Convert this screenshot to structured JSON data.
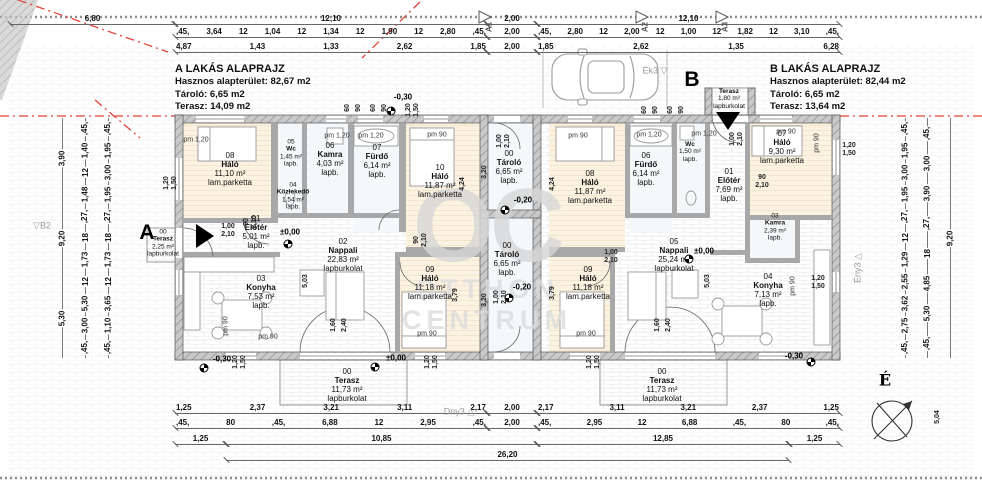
{
  "title_blocks": {
    "left": {
      "title": "A LAKÁS ALAPRAJZ",
      "l1": "Hasznos alapterület: 82,67 m2",
      "l2": "Tároló: 6,65 m2",
      "l3": "Terasz:  14,09 m2"
    },
    "right": {
      "title": "B LAKÁS ALAPRAJZ",
      "l1": "Hasznos alapterület: 82,44 m2",
      "l2": "Tároló: 6,65 m2",
      "l3": "Terasz:  13,64 m2"
    }
  },
  "watermark": {
    "big": "OC",
    "l1": "OTTHON",
    "l2": "CENTRUM"
  },
  "rooms": [
    {
      "n": "08",
      "nm": "Háló",
      "a": "11,10 m²",
      "f": "lam.parketta",
      "x": 230,
      "y": 170
    },
    {
      "n": "05",
      "nm": "Wc",
      "a": "1,45 m²",
      "f": "lapb.",
      "x": 291,
      "y": 153,
      "s": 1
    },
    {
      "n": "06",
      "nm": "Kamra",
      "a": "4,03 m²",
      "f": "lapb.",
      "x": 330,
      "y": 160
    },
    {
      "n": "07",
      "nm": "Fürdő",
      "a": "6,14 m²",
      "f": "lapb.",
      "x": 377,
      "y": 162
    },
    {
      "n": "10",
      "nm": "Háló",
      "a": "11,87 m²",
      "f": "lam.parketta",
      "x": 440,
      "y": 182
    },
    {
      "n": "04",
      "nm": "Közlekedő",
      "a": "1,54 m²",
      "f": "lapb.",
      "x": 293,
      "y": 196,
      "s": 1
    },
    {
      "n": "01",
      "nm": "Előtér",
      "a": "5,01 m²",
      "f": "lapb.",
      "x": 256,
      "y": 233
    },
    {
      "n": "00",
      "nm": "Terasz",
      "a": "2,25 m²",
      "f": "lapburkolat",
      "x": 163,
      "y": 243,
      "s": 1
    },
    {
      "n": "02",
      "nm": "Nappali",
      "a": "22,83 m²",
      "f": "lapburkolat",
      "x": 343,
      "y": 256
    },
    {
      "n": "03",
      "nm": "Konyha",
      "a": "7,53 m²",
      "f": "lapb.",
      "x": 261,
      "y": 293
    },
    {
      "n": "09",
      "nm": "Háló",
      "a": "11,18 m²",
      "f": "lam.parketta",
      "x": 430,
      "y": 284
    },
    {
      "n": "00",
      "nm": "Tároló",
      "a": "6,65 m²",
      "f": "lapb.",
      "x": 509,
      "y": 168
    },
    {
      "n": "00",
      "nm": "Tároló",
      "a": "6,65 m²",
      "f": "lapb.",
      "x": 507,
      "y": 260
    },
    {
      "n": "00",
      "nm": "Terasz",
      "a": "11,73 m²",
      "f": "lapburkolat",
      "x": 347,
      "y": 386
    },
    {
      "n": "08",
      "nm": "Háló",
      "a": "11,87 m²",
      "f": "lam.parketta",
      "x": 590,
      "y": 188
    },
    {
      "n": "06",
      "nm": "Fürdő",
      "a": "6,14 m²",
      "f": "lapb.",
      "x": 646,
      "y": 170
    },
    {
      "n": "",
      "nm": "Wc",
      "a": "1,50 m²",
      "f": "lapb.",
      "x": 690,
      "y": 152,
      "s": 1
    },
    {
      "n": "01",
      "nm": "Előtér",
      "a": "7,69 m²",
      "f": "lapb.",
      "x": 729,
      "y": 186
    },
    {
      "n": "07",
      "nm": "Háló",
      "a": "9,30 m²",
      "f": "lam.parketta",
      "x": 782,
      "y": 148
    },
    {
      "n": "03",
      "nm": "Kamra",
      "a": "2,39 m²",
      "f": "lapb.",
      "x": 775,
      "y": 227,
      "s": 1
    },
    {
      "n": "04",
      "nm": "Konyha",
      "a": "7,13 m²",
      "f": "lapb.",
      "x": 768,
      "y": 291
    },
    {
      "n": "05",
      "nm": "Nappali",
      "a": "25,24 m²",
      "f": "lapburkolat",
      "x": 674,
      "y": 256
    },
    {
      "n": "09",
      "nm": "Háló",
      "a": "11,18 m²",
      "f": "lam.parketta",
      "x": 588,
      "y": 284
    },
    {
      "n": "",
      "nm": "Terasz",
      "a": "1,80 m²",
      "f": "lapburkolat",
      "x": 729,
      "y": 99,
      "s": 1
    },
    {
      "n": "00",
      "nm": "Terasz",
      "a": "11,73 m²",
      "f": "lapburkolat",
      "x": 662,
      "y": 386
    }
  ],
  "dim_rows": [
    {
      "y": 24,
      "segs": [
        {
          "x1": 10,
          "x2": 175,
          "v": [
            "6,80"
          ]
        },
        {
          "x1": 175,
          "x2": 487,
          "v": [
            "12,10"
          ]
        },
        {
          "x1": 487,
          "x2": 537,
          "v": [
            "2,00"
          ]
        },
        {
          "x1": 537,
          "x2": 840,
          "v": [
            "12,10"
          ]
        }
      ]
    },
    {
      "y": 37,
      "segs": [
        {
          "x1": 175,
          "x2": 487,
          "v": [
            ",45,",
            "3,64",
            "12",
            "1,04",
            "12",
            "1,34",
            "12",
            "1,90",
            "12",
            "2,80",
            ",45,"
          ]
        },
        {
          "x1": 487,
          "x2": 537,
          "v": [
            "2,00"
          ]
        },
        {
          "x1": 537,
          "x2": 840,
          "v": [
            ",45,",
            "2,80",
            "12",
            "2,00",
            "12",
            "1,00",
            "12",
            "1,82",
            "12",
            "3,10",
            ",45,"
          ]
        }
      ]
    },
    {
      "y": 52,
      "segs": [
        {
          "x1": 175,
          "x2": 487,
          "v": [
            "4,87",
            "1,43",
            "1,33",
            "2,62",
            "1,85"
          ]
        },
        {
          "x1": 487,
          "x2": 537,
          "v": [
            "2,00"
          ]
        },
        {
          "x1": 537,
          "x2": 840,
          "v": [
            "1,85",
            "2,62",
            "1,35",
            "6,28"
          ]
        }
      ]
    },
    {
      "y": 413,
      "segs": [
        {
          "x1": 175,
          "x2": 487,
          "v": [
            "1,25",
            "2,37",
            "3,21",
            "3,11",
            "2,17"
          ]
        },
        {
          "x1": 487,
          "x2": 537,
          "v": [
            "2,00"
          ]
        },
        {
          "x1": 537,
          "x2": 840,
          "v": [
            "2,17",
            "3,11",
            "3,21",
            "2,37",
            "1,25"
          ]
        }
      ]
    },
    {
      "y": 428,
      "segs": [
        {
          "x1": 175,
          "x2": 487,
          "v": [
            ",45,",
            "80",
            ",45,",
            "6,88",
            "12",
            "2,95",
            ",45,"
          ]
        },
        {
          "x1": 487,
          "x2": 537,
          "v": [
            "2,00"
          ]
        },
        {
          "x1": 537,
          "x2": 840,
          "v": [
            ",45,",
            "2,95",
            "12",
            "6,88",
            ",45,",
            "80",
            ",45,"
          ]
        }
      ]
    },
    {
      "y": 444,
      "segs": [
        {
          "x1": 175,
          "x2": 226,
          "v": [
            "1,25"
          ]
        },
        {
          "x1": 226,
          "x2": 537,
          "v": [
            "10,85"
          ]
        },
        {
          "x1": 537,
          "x2": 789,
          "v": [
            "12,85"
          ]
        },
        {
          "x1": 789,
          "x2": 840,
          "v": [
            "1,25"
          ]
        }
      ]
    },
    {
      "y": 460,
      "segs": [
        {
          "x1": 226,
          "x2": 789,
          "v": [
            "26,20"
          ]
        }
      ]
    }
  ],
  "vchains": [
    {
      "x": 62,
      "y1": 118,
      "y2": 358,
      "v": [
        "3,90",
        "9,20",
        "5,30"
      ]
    },
    {
      "x": 85,
      "y1": 118,
      "y2": 358,
      "v": [
        ",45,",
        "1,40",
        "12",
        "1,48",
        ",27,",
        "18",
        "1,73",
        "12",
        "5,30",
        "3,00",
        ",45,"
      ]
    },
    {
      "x": 108,
      "y1": 118,
      "y2": 358,
      "v": [
        ",45,",
        "1,95",
        "3,00",
        "1,95",
        ",27,",
        "18",
        "1,73",
        "12",
        "3,65",
        "1,10",
        ",45,"
      ]
    },
    {
      "x": 905,
      "y1": 118,
      "y2": 358,
      "v": [
        ",45,",
        "1,95",
        "3,00",
        "1,95",
        ",27,",
        "12",
        "1,29",
        "2,55",
        "3,62",
        "2,75",
        ",45,"
      ]
    },
    {
      "x": 927,
      "y1": 118,
      "y2": 358,
      "v": [
        ",45,",
        "3,00",
        "3,90",
        ",27,",
        "18",
        "4,85",
        "5,30",
        ",45,"
      ]
    },
    {
      "x": 950,
      "y1": 118,
      "y2": 358,
      "v": [
        "9,20"
      ]
    }
  ],
  "elevations": [
    {
      "t": "-0,30",
      "x": 403,
      "y": 97,
      "cx": 391,
      "cy": 111
    },
    {
      "t": "±0,00",
      "x": 290,
      "y": 232,
      "cx": 288,
      "cy": 244
    },
    {
      "t": "-0,20",
      "x": 523,
      "y": 200,
      "cx": 505,
      "cy": 210
    },
    {
      "t": "-0,20",
      "x": 522,
      "y": 287,
      "cx": 509,
      "cy": 298
    },
    {
      "t": "±0,00",
      "x": 704,
      "y": 251,
      "cx": 689,
      "cy": 259
    },
    {
      "t": "±0,00",
      "x": 396,
      "y": 358,
      "cx": 375,
      "cy": 367
    },
    {
      "t": "-0,30",
      "x": 222,
      "y": 359,
      "cx": 204,
      "cy": 368
    },
    {
      "t": "-0,30",
      "x": 794,
      "y": 356,
      "cx": 811,
      "cy": 362
    }
  ],
  "pm_labels": [
    {
      "t": "pm 1,20",
      "x": 196,
      "y": 140
    },
    {
      "t": "pm 1,20",
      "x": 337,
      "y": 136
    },
    {
      "t": "pm 1,20",
      "x": 371,
      "y": 136
    },
    {
      "t": "pm 90",
      "x": 437,
      "y": 135
    },
    {
      "t": "pm 90",
      "x": 578,
      "y": 136
    },
    {
      "t": "pm 1,20",
      "x": 649,
      "y": 135
    },
    {
      "t": "pm 1,20",
      "x": 704,
      "y": 134
    },
    {
      "t": "pm 90",
      "x": 786,
      "y": 132
    },
    {
      "t": "pm 90",
      "x": 817,
      "y": 143,
      "r": 1
    },
    {
      "t": "pm 90",
      "x": 793,
      "y": 286,
      "r": 1
    },
    {
      "t": "pm 90",
      "x": 226,
      "y": 326,
      "r": 1
    },
    {
      "t": "pm 90",
      "x": 268,
      "y": 337
    },
    {
      "t": "pm 90",
      "x": 427,
      "y": 334
    },
    {
      "t": "pm 90",
      "x": 586,
      "y": 334
    }
  ],
  "small_labels": [
    {
      "l": [
        "1,00",
        "2,10"
      ],
      "x": 228,
      "y": 231
    },
    {
      "l": [
        "90",
        "2,10"
      ],
      "x": 251,
      "y": 222,
      "r": 1
    },
    {
      "l": [
        "90",
        "2,10"
      ],
      "x": 421,
      "y": 240,
      "r": 1
    },
    {
      "l": [
        "1,00",
        "2,10"
      ],
      "x": 504,
      "y": 141,
      "r": 1
    },
    {
      "l": [
        "1,00",
        "2,10"
      ],
      "x": 501,
      "y": 297,
      "r": 1
    },
    {
      "l": [
        "1,00",
        "2,10"
      ],
      "x": 611,
      "y": 257
    },
    {
      "l": [
        "1,00",
        "2,10"
      ],
      "x": 737,
      "y": 139,
      "r": 1
    },
    {
      "l": [
        "90",
        "2,10"
      ],
      "x": 762,
      "y": 182
    },
    {
      "l": [
        "1,20",
        "1,50"
      ],
      "x": 171,
      "y": 183,
      "r": 1
    },
    {
      "l": [
        "1,20",
        "1,50"
      ],
      "x": 849,
      "y": 150
    },
    {
      "l": [
        "1,20",
        "1,50"
      ],
      "x": 818,
      "y": 283
    },
    {
      "l": [
        "1,20",
        "1,50"
      ],
      "x": 240,
      "y": 362,
      "r": 1
    },
    {
      "l": [
        "1,20",
        "1,50"
      ],
      "x": 432,
      "y": 362,
      "r": 1
    },
    {
      "l": [
        "1,20",
        "1,50"
      ],
      "x": 594,
      "y": 362,
      "r": 1
    },
    {
      "l": [
        "1,20",
        "1,50"
      ],
      "x": 413,
      "y": 110,
      "r": 1
    },
    {
      "l": [
        "60"
      ],
      "x": 348,
      "y": 108,
      "r": 1
    },
    {
      "l": [
        "90"
      ],
      "x": 359,
      "y": 108,
      "r": 1
    },
    {
      "l": [
        "60"
      ],
      "x": 374,
      "y": 108,
      "r": 1
    },
    {
      "l": [
        "90"
      ],
      "x": 385,
      "y": 108,
      "r": 1
    },
    {
      "l": [
        "60"
      ],
      "x": 645,
      "y": 110,
      "r": 1
    },
    {
      "l": [
        "90"
      ],
      "x": 656,
      "y": 110,
      "r": 1
    },
    {
      "l": [
        "60"
      ],
      "x": 671,
      "y": 110,
      "r": 1
    },
    {
      "l": [
        "90"
      ],
      "x": 682,
      "y": 110,
      "r": 1
    },
    {
      "l": [
        "3,20"
      ],
      "x": 485,
      "y": 172,
      "r": 1
    },
    {
      "l": [
        "3,20"
      ],
      "x": 485,
      "y": 300,
      "r": 1
    },
    {
      "l": [
        "4,24"
      ],
      "x": 463,
      "y": 184,
      "r": 1
    },
    {
      "l": [
        "4,24"
      ],
      "x": 553,
      "y": 184,
      "r": 1
    },
    {
      "l": [
        "5,03"
      ],
      "x": 306,
      "y": 281,
      "r": 1
    },
    {
      "l": [
        "5,03"
      ],
      "x": 708,
      "y": 281,
      "r": 1
    },
    {
      "l": [
        "3,79"
      ],
      "x": 456,
      "y": 295,
      "r": 1
    },
    {
      "l": [
        "3,79"
      ],
      "x": 553,
      "y": 293,
      "r": 1
    },
    {
      "l": [
        "1,60"
      ],
      "x": 334,
      "y": 325,
      "r": 1
    },
    {
      "l": [
        "2,40"
      ],
      "x": 345,
      "y": 325,
      "r": 1
    },
    {
      "l": [
        "1,60"
      ],
      "x": 658,
      "y": 325,
      "r": 1
    },
    {
      "l": [
        "2,40"
      ],
      "x": 669,
      "y": 325,
      "r": 1
    },
    {
      "l": [
        "5,04"
      ],
      "x": 938,
      "y": 417,
      "r": 1
    }
  ],
  "markers": [
    {
      "t": "A",
      "x": 147,
      "y": 233,
      "c": "big"
    },
    {
      "t": "B",
      "x": 692,
      "y": 80,
      "c": "big"
    },
    {
      "t": "Ék3 ▽",
      "x": 655,
      "y": 71,
      "c": "corner"
    },
    {
      "t": "Ény3 △",
      "x": 858,
      "y": 268,
      "c": "corner",
      "r": 1
    },
    {
      "t": "Dny3 △",
      "x": 459,
      "y": 412,
      "c": "corner"
    },
    {
      "t": "▽B2",
      "x": 42,
      "y": 226,
      "c": "corner"
    },
    {
      "t": "A1",
      "x": 489,
      "y": 27,
      "c": "section",
      "r": 1
    },
    {
      "t": "A2",
      "x": 645,
      "y": 27,
      "c": "section",
      "r": 1
    },
    {
      "t": "A3",
      "x": 725,
      "y": 27,
      "c": "section",
      "r": 1
    },
    {
      "t": "É",
      "x": 885,
      "y": 380,
      "c": "north"
    }
  ],
  "colors": {
    "boundary_red": "#e04438",
    "wall_gray": "#c9c9c9",
    "dim_line": "#666666",
    "watermark_gray": "#d7d7d7"
  }
}
